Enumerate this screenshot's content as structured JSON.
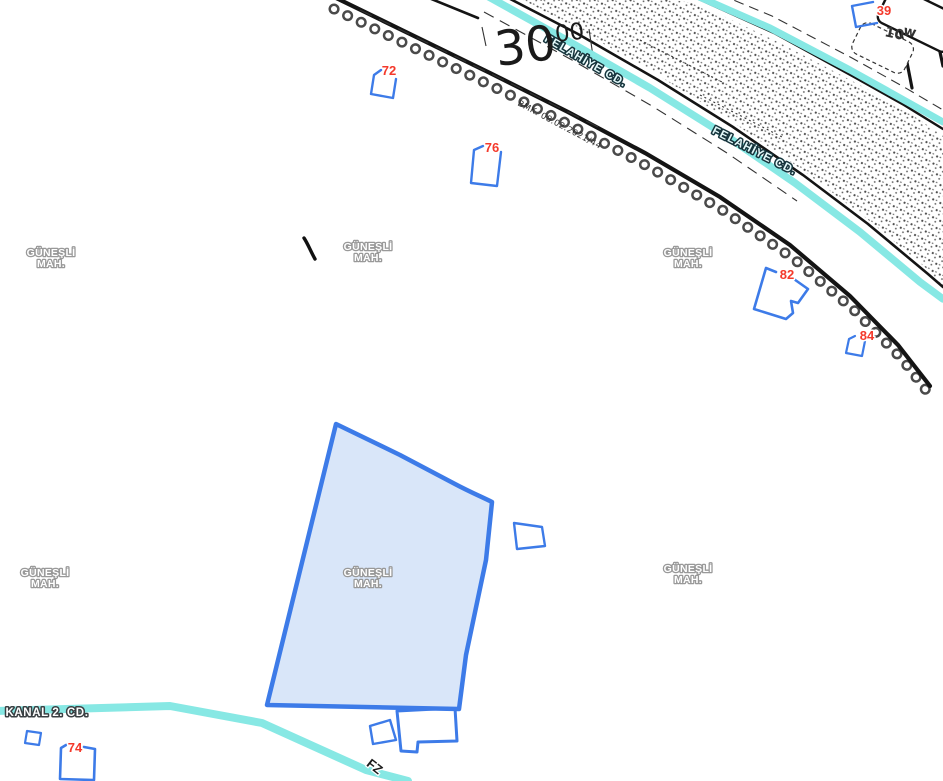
{
  "map": {
    "neighborhood": {
      "line1": "GÜNEŞLİ",
      "line2": "MAH."
    },
    "street_felahiye": "FELAHİYE CD.",
    "street_kanal": "KANAL 2. CD.",
    "block_number": "30",
    "block_sup": "00",
    "survey_note": "BMK. 08.02.2021/44",
    "corner_block": "10",
    "corner_block_sup": "w",
    "edge_label_fragment": "FZ",
    "parcel_numbers": {
      "n39": "39",
      "n72": "72",
      "n74": "74",
      "n76": "76",
      "n82": "82",
      "n84": "84"
    },
    "colors": {
      "water": "#87E8E4",
      "parcel_stroke": "#3D7BE8",
      "selected_parcel_fill": "#D9E6F9",
      "parcel_number_red": "#F4392B",
      "road_black": "#141414",
      "label_halo_gray": "#999999"
    }
  }
}
